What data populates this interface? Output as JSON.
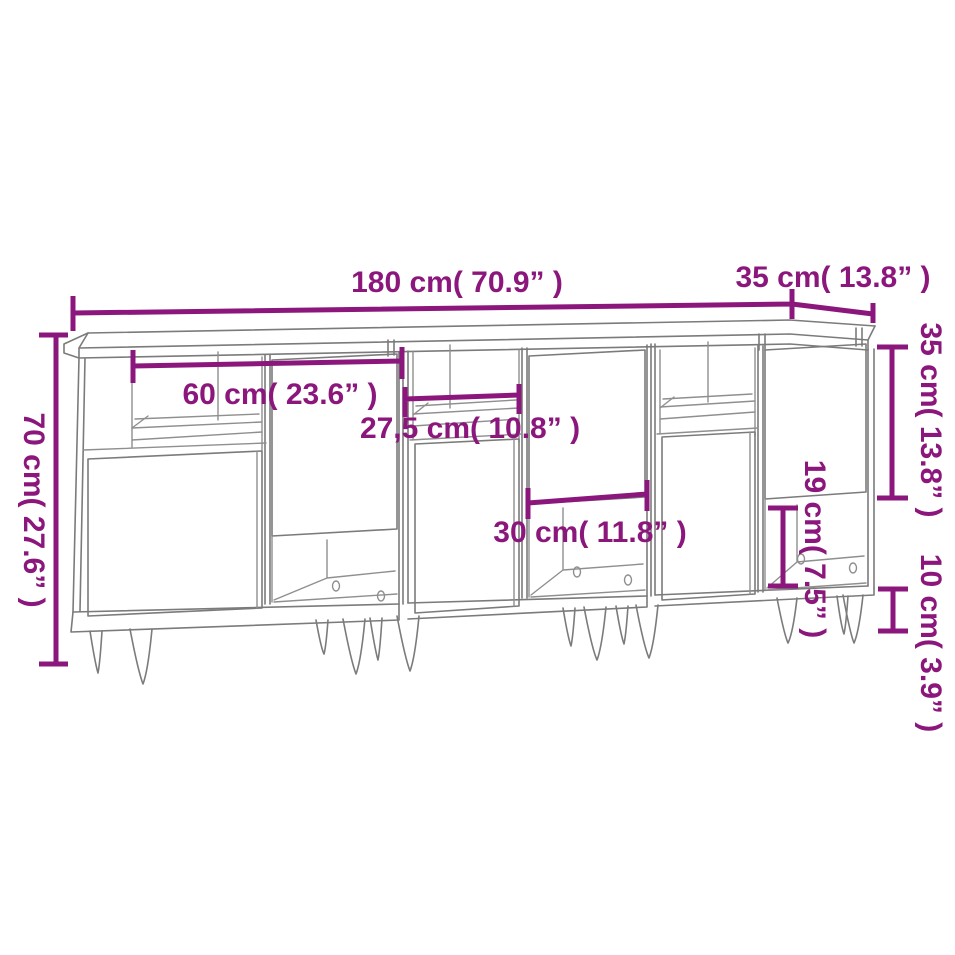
{
  "diagram_type": "furniture-dimension-diagram",
  "product": "set of three sideboards with hairpin legs",
  "colors": {
    "dimension_accent": "#8C177C",
    "furniture_line": "#7b7b7b",
    "background": "#ffffff"
  },
  "dimensions": {
    "total_width": {
      "label": "180 cm( 70.9”  )"
    },
    "total_depth": {
      "label": "35 cm( 13.8”  )"
    },
    "total_height": {
      "label": "70 cm( 27.6”  )"
    },
    "unit_width": {
      "label": "60 cm( 23.6”  )"
    },
    "shelf_width": {
      "label": "27,5 cm( 10.8”  )"
    },
    "compartment_width": {
      "label": "30 cm( 11.8”  )"
    },
    "door_height": {
      "label": "35 cm( 13.8”  )"
    },
    "compartment_height": {
      "label": "19 cm( 7.5”  )"
    },
    "leg_height": {
      "label": "10 cm( 3.9”  )"
    }
  }
}
